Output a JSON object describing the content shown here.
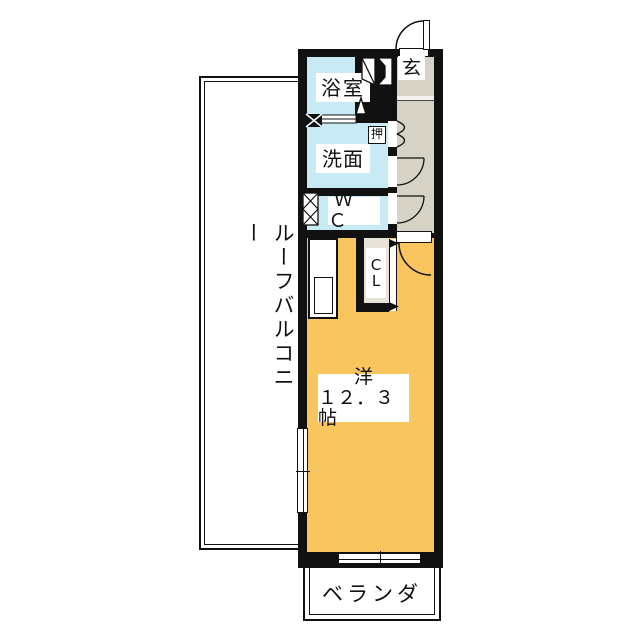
{
  "plan": {
    "type": "floor-plan",
    "areas": {
      "roof_balcony": {
        "label": "ルーフバルコニー"
      },
      "bathroom": {
        "label": "浴室"
      },
      "entrance": {
        "label": "玄"
      },
      "storage": {
        "label": "押"
      },
      "washroom": {
        "label": "洗面"
      },
      "toilet": {
        "label": "ＷＣ"
      },
      "closet": {
        "label_line1": "C",
        "label_line2": "L"
      },
      "main_room": {
        "label_line1": "洋",
        "label_line2": "１２．３帖",
        "size_tatami": "12.3"
      },
      "veranda": {
        "label": "ベランダ"
      }
    },
    "colors": {
      "wall": "#111111",
      "wet_rooms": "#c7eaf5",
      "hallway": "#d6d2c6",
      "main_room": "#f8c55f",
      "closet_fill": "#e7e3da",
      "background": "#ffffff"
    },
    "icons": [
      "entrance-door-swing-icon",
      "room-door-swing-icon",
      "washroom-door-swing-icon",
      "wc-door-swing-icon",
      "bifold-door-icon",
      "closet-folding-door-icon",
      "shoe-cabinet-icon",
      "bath-door-icon",
      "vent-window-x-icon",
      "sliding-window-icon"
    ]
  }
}
